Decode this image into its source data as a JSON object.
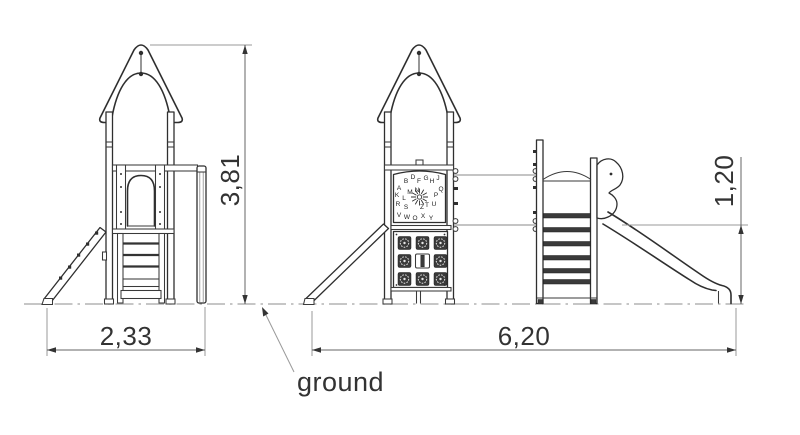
{
  "drawing": {
    "dimensions": {
      "front_width": "2,33",
      "overall_height": "3,81",
      "overall_length": "6,20",
      "platform_height": "1,20"
    },
    "ground_label": "ground",
    "alphabet_panel_letters": "ABDFGHJKLMNPQRSTUVWOXYZ"
  },
  "colors": {
    "outline": "#2f2f2f",
    "dimension_line": "#666666",
    "extension_line": "#9a9a9a",
    "ground_line": "#a5a5a5",
    "slat_fill": "#3a3a3a",
    "text": "#333333",
    "background": "#ffffff"
  }
}
